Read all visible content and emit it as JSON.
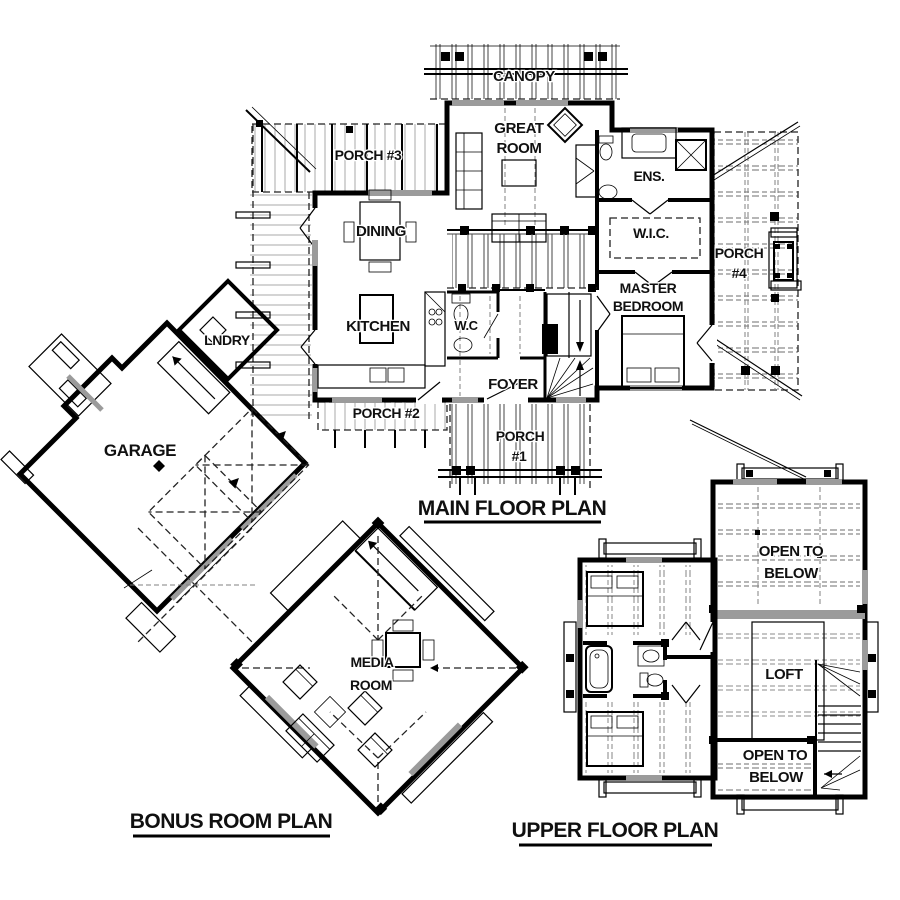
{
  "colors": {
    "wall": "#000000",
    "background": "#ffffff",
    "window_gray": "#9b9b9b",
    "text": "#101010"
  },
  "main_floor": {
    "title": "MAIN FLOOR PLAN",
    "labels": {
      "canopy": "CANOPY",
      "great_room": [
        "GREAT",
        "ROOM"
      ],
      "porch_3": "PORCH #3",
      "dining": "DINING",
      "ensuite": "ENS.",
      "walk_in_closet": "W.I.C.",
      "porch_4": [
        "PORCH",
        "#4"
      ],
      "master_bedroom": [
        "MASTER",
        "BEDROOM"
      ],
      "kitchen": "KITCHEN",
      "water_closet": "W.C",
      "laundry": "LNDRY",
      "foyer": "FOYER",
      "porch_2": "PORCH #2",
      "porch_1": [
        "PORCH",
        "#1"
      ],
      "garage": "GARAGE"
    }
  },
  "bonus_room": {
    "title": "BONUS ROOM PLAN",
    "labels": {
      "media_room": [
        "MEDIA",
        "ROOM"
      ]
    }
  },
  "upper_floor": {
    "title": "UPPER FLOOR PLAN",
    "labels": {
      "open_to_below_top": [
        "OPEN TO",
        "BELOW"
      ],
      "loft": "LOFT",
      "open_to_below_bottom": [
        "OPEN TO",
        "BELOW"
      ]
    }
  }
}
